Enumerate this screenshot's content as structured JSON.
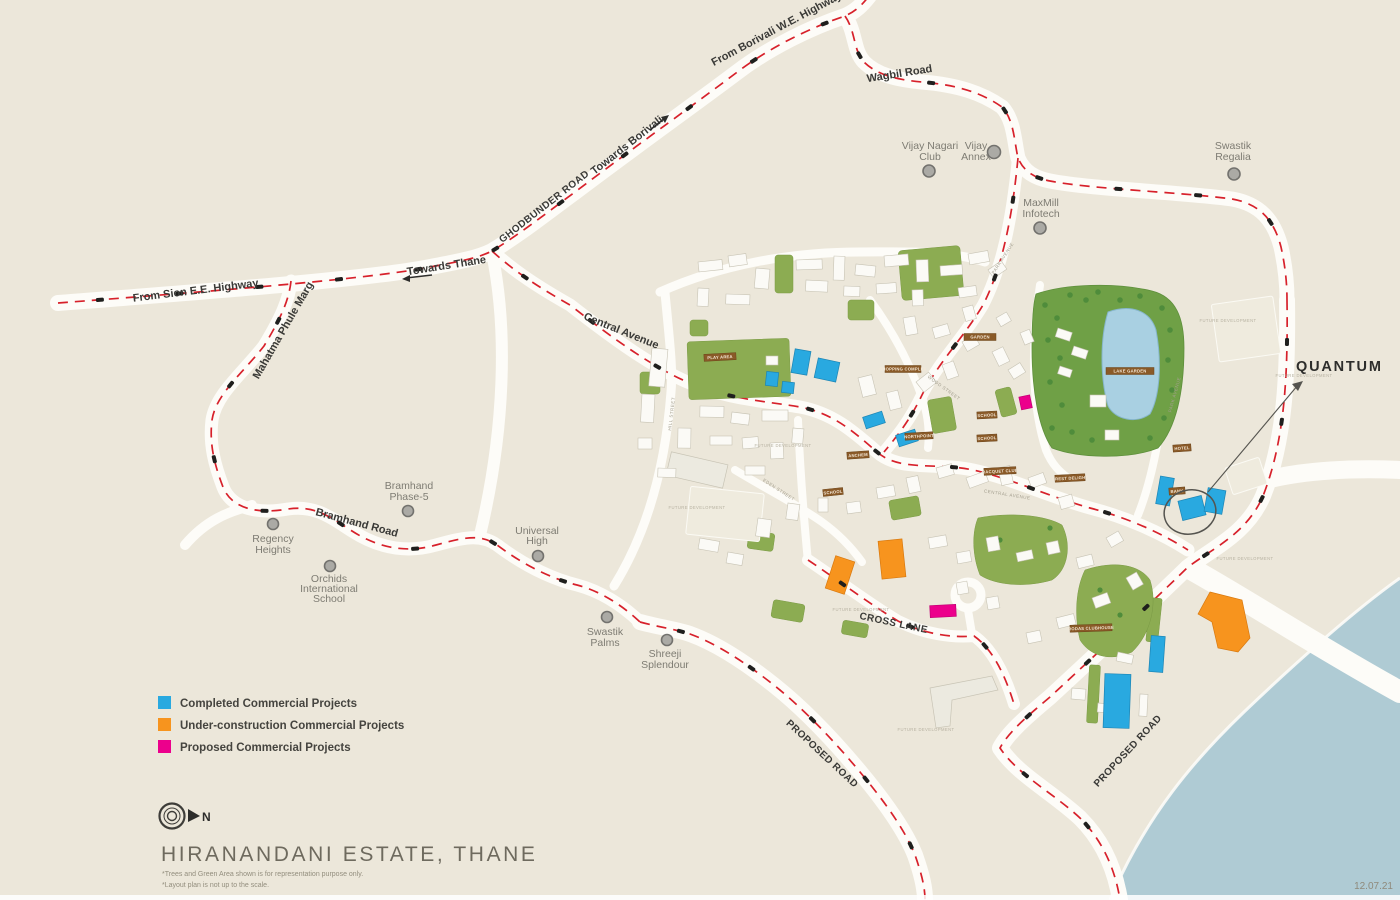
{
  "map": {
    "title": "HIRANANDANI ESTATE, THANE",
    "notes": [
      "*Trees and Green Area shown is for representation purpose only.",
      "*Layout plan is not up to the scale."
    ],
    "date": "12.07.21",
    "compass": "N",
    "callout": "QUANTUM",
    "legend": [
      {
        "label": "Completed Commercial Projects",
        "color": "#29A9E0"
      },
      {
        "label": "Under-construction Commercial Projects",
        "color": "#F7941E"
      },
      {
        "label": "Proposed Commercial Projects",
        "color": "#EC008C"
      }
    ],
    "road_labels": {
      "borivali_hwy": "From Borivali W.E. Highway",
      "towards_borivali": "Towards Borivali",
      "ghodbunder": "GHODBUNDER ROAD",
      "wagbil": "Wagbil Road",
      "sion_hwy": "From Sion E.E. Highway",
      "towards_thane": "Towards Thane",
      "mahatma_phule": "Mahatma Phule Marg",
      "central_avenue": "Central Avenue",
      "bramhand": "Bramhand Road",
      "cross_lane": "CROSS LANE",
      "proposed_1": "PROPOSED ROAD",
      "proposed_2": "PROPOSED ROAD"
    },
    "landmarks": [
      {
        "name": "Vijay Nagari Club",
        "lines": [
          "Vijay Nagari",
          "Club"
        ]
      },
      {
        "name": "Vijay Annex",
        "lines": [
          "Vijay",
          "Annex"
        ]
      },
      {
        "name": "Swastik Regalia",
        "lines": [
          "Swastik",
          "Regalia"
        ]
      },
      {
        "name": "MaxMill Infotech",
        "lines": [
          "MaxMill",
          "Infotech"
        ]
      },
      {
        "name": "Bramhand Phase-5",
        "lines": [
          "Bramhand",
          "Phase-5"
        ]
      },
      {
        "name": "Regency Heights",
        "lines": [
          "Regency",
          "Heights"
        ]
      },
      {
        "name": "Orchids International School",
        "lines": [
          "Orchids",
          "International",
          "School"
        ]
      },
      {
        "name": "Universal High",
        "lines": [
          "Universal",
          "High"
        ]
      },
      {
        "name": "Swastik Palms",
        "lines": [
          "Swastik",
          "Palms"
        ]
      },
      {
        "name": "Shreeji Splendour",
        "lines": [
          "Shreeji",
          "Splendour"
        ]
      }
    ],
    "estate_tags": [
      "PLAY AREA",
      "SHOPPING COMPLEX",
      "GARDEN",
      "LAKE GARDEN",
      "NORTHPOINT",
      "SCHOOL",
      "SCHOOL",
      "SCHOOL",
      "RACQUET CLUB",
      "CREST DELIGHT",
      "ANCHEM",
      "RODAS CLUBHOUSE",
      "HOTEL",
      "BANK"
    ],
    "street_names": [
      "PARK AVENUE",
      "WOOD STREET",
      "CENTRAL AVENUE",
      "EDEN STREET",
      "HILL STREET",
      "PARK AVENUE"
    ],
    "area_note": "FUTURE DEVELOPMENT"
  }
}
